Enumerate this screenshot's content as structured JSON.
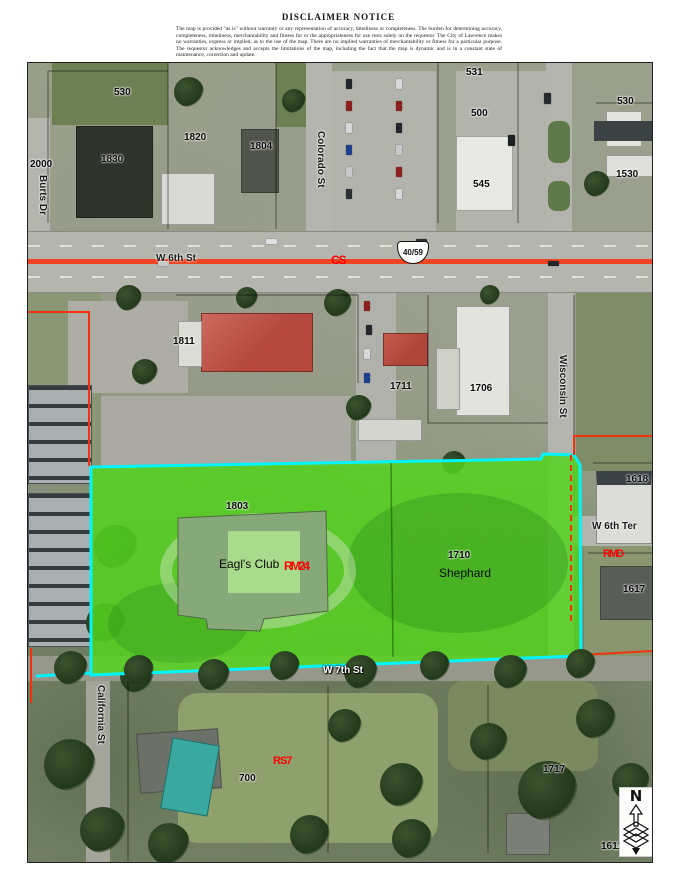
{
  "disclaimer": {
    "title": "DISCLAIMER NOTICE",
    "body": "The map is provided \"as is\" without warranty or any representation of accuracy, timeliness or completeness.  The burden for determining accuracy, completeness, timeliness, merchantability and fitness for or the appropriateness for use rests solely on the requestor.  The City of Lawrence makes no warranties, express or implied, as to the use of the map.  There are no implied warranties of merchantability or fitness for a particular purpose.  The requestor acknowledges and accepts the limitations of the map, including the fact that the map is dynamic and is in a constant state of maintenance, correction and update."
  },
  "map": {
    "highway_shield": "40/59",
    "north_arrow_label": "N",
    "streets": {
      "w6th_st": "W 6th St",
      "w7th_st": "W 7th St",
      "w6th_ter": "W 6th Ter",
      "burts_dr": "Burts Dr",
      "colorado_st": "Colorado St",
      "wisconsin_st": "Wisconsin St",
      "california_st": "California St"
    },
    "zoning_labels": {
      "corridor": "CS",
      "subject_parcel": "RM24",
      "east": "RMD",
      "south": "RS7"
    },
    "parcels": {
      "eagles_number": "1803",
      "eagles_name": "Eagl's Club",
      "shephard_number": "1710",
      "shephard_name": "Shephard"
    },
    "addresses": [
      "2000",
      "530",
      "1820",
      "1830",
      "1804",
      "531",
      "500",
      "545",
      "530",
      "1530",
      "1811",
      "1711",
      "1706",
      "1618",
      "1617",
      "700",
      "1717",
      "1611"
    ]
  },
  "colors": {
    "parcel_fill": "#55D41F",
    "parcel_outline": "#00F5FF",
    "zoning_line": "#F2330F",
    "zoning_text": "#FF0000",
    "road_centerline": "#EF4523"
  }
}
